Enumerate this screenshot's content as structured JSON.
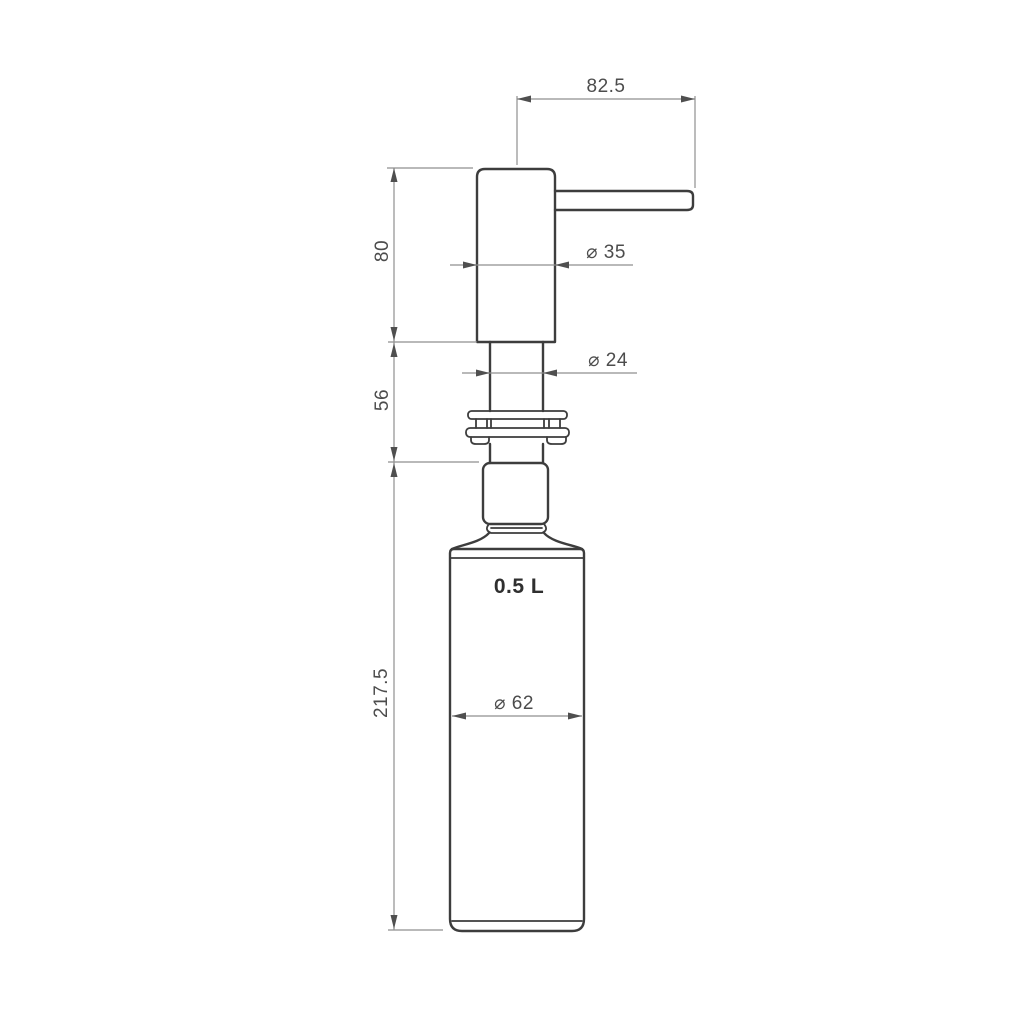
{
  "drawing": {
    "kind": "soap-dispenser-technical-drawing",
    "capacity_label": "0.5 L"
  },
  "dimensions": {
    "spout_reach": "82.5",
    "pump_head_height": "80",
    "neck_section_height": "56",
    "bottle_height": "217.5",
    "head_diameter": "⌀ 35",
    "tube_diameter": "⌀ 24",
    "bottle_diameter": "⌀ 62"
  },
  "colors": {
    "bg": "#ffffff",
    "outline": "#3d3d3d",
    "dimline": "#8f8f8f",
    "arrow": "#4f4f4f",
    "dimtext": "#4c4c4c",
    "captext": "#2f2f2f"
  }
}
